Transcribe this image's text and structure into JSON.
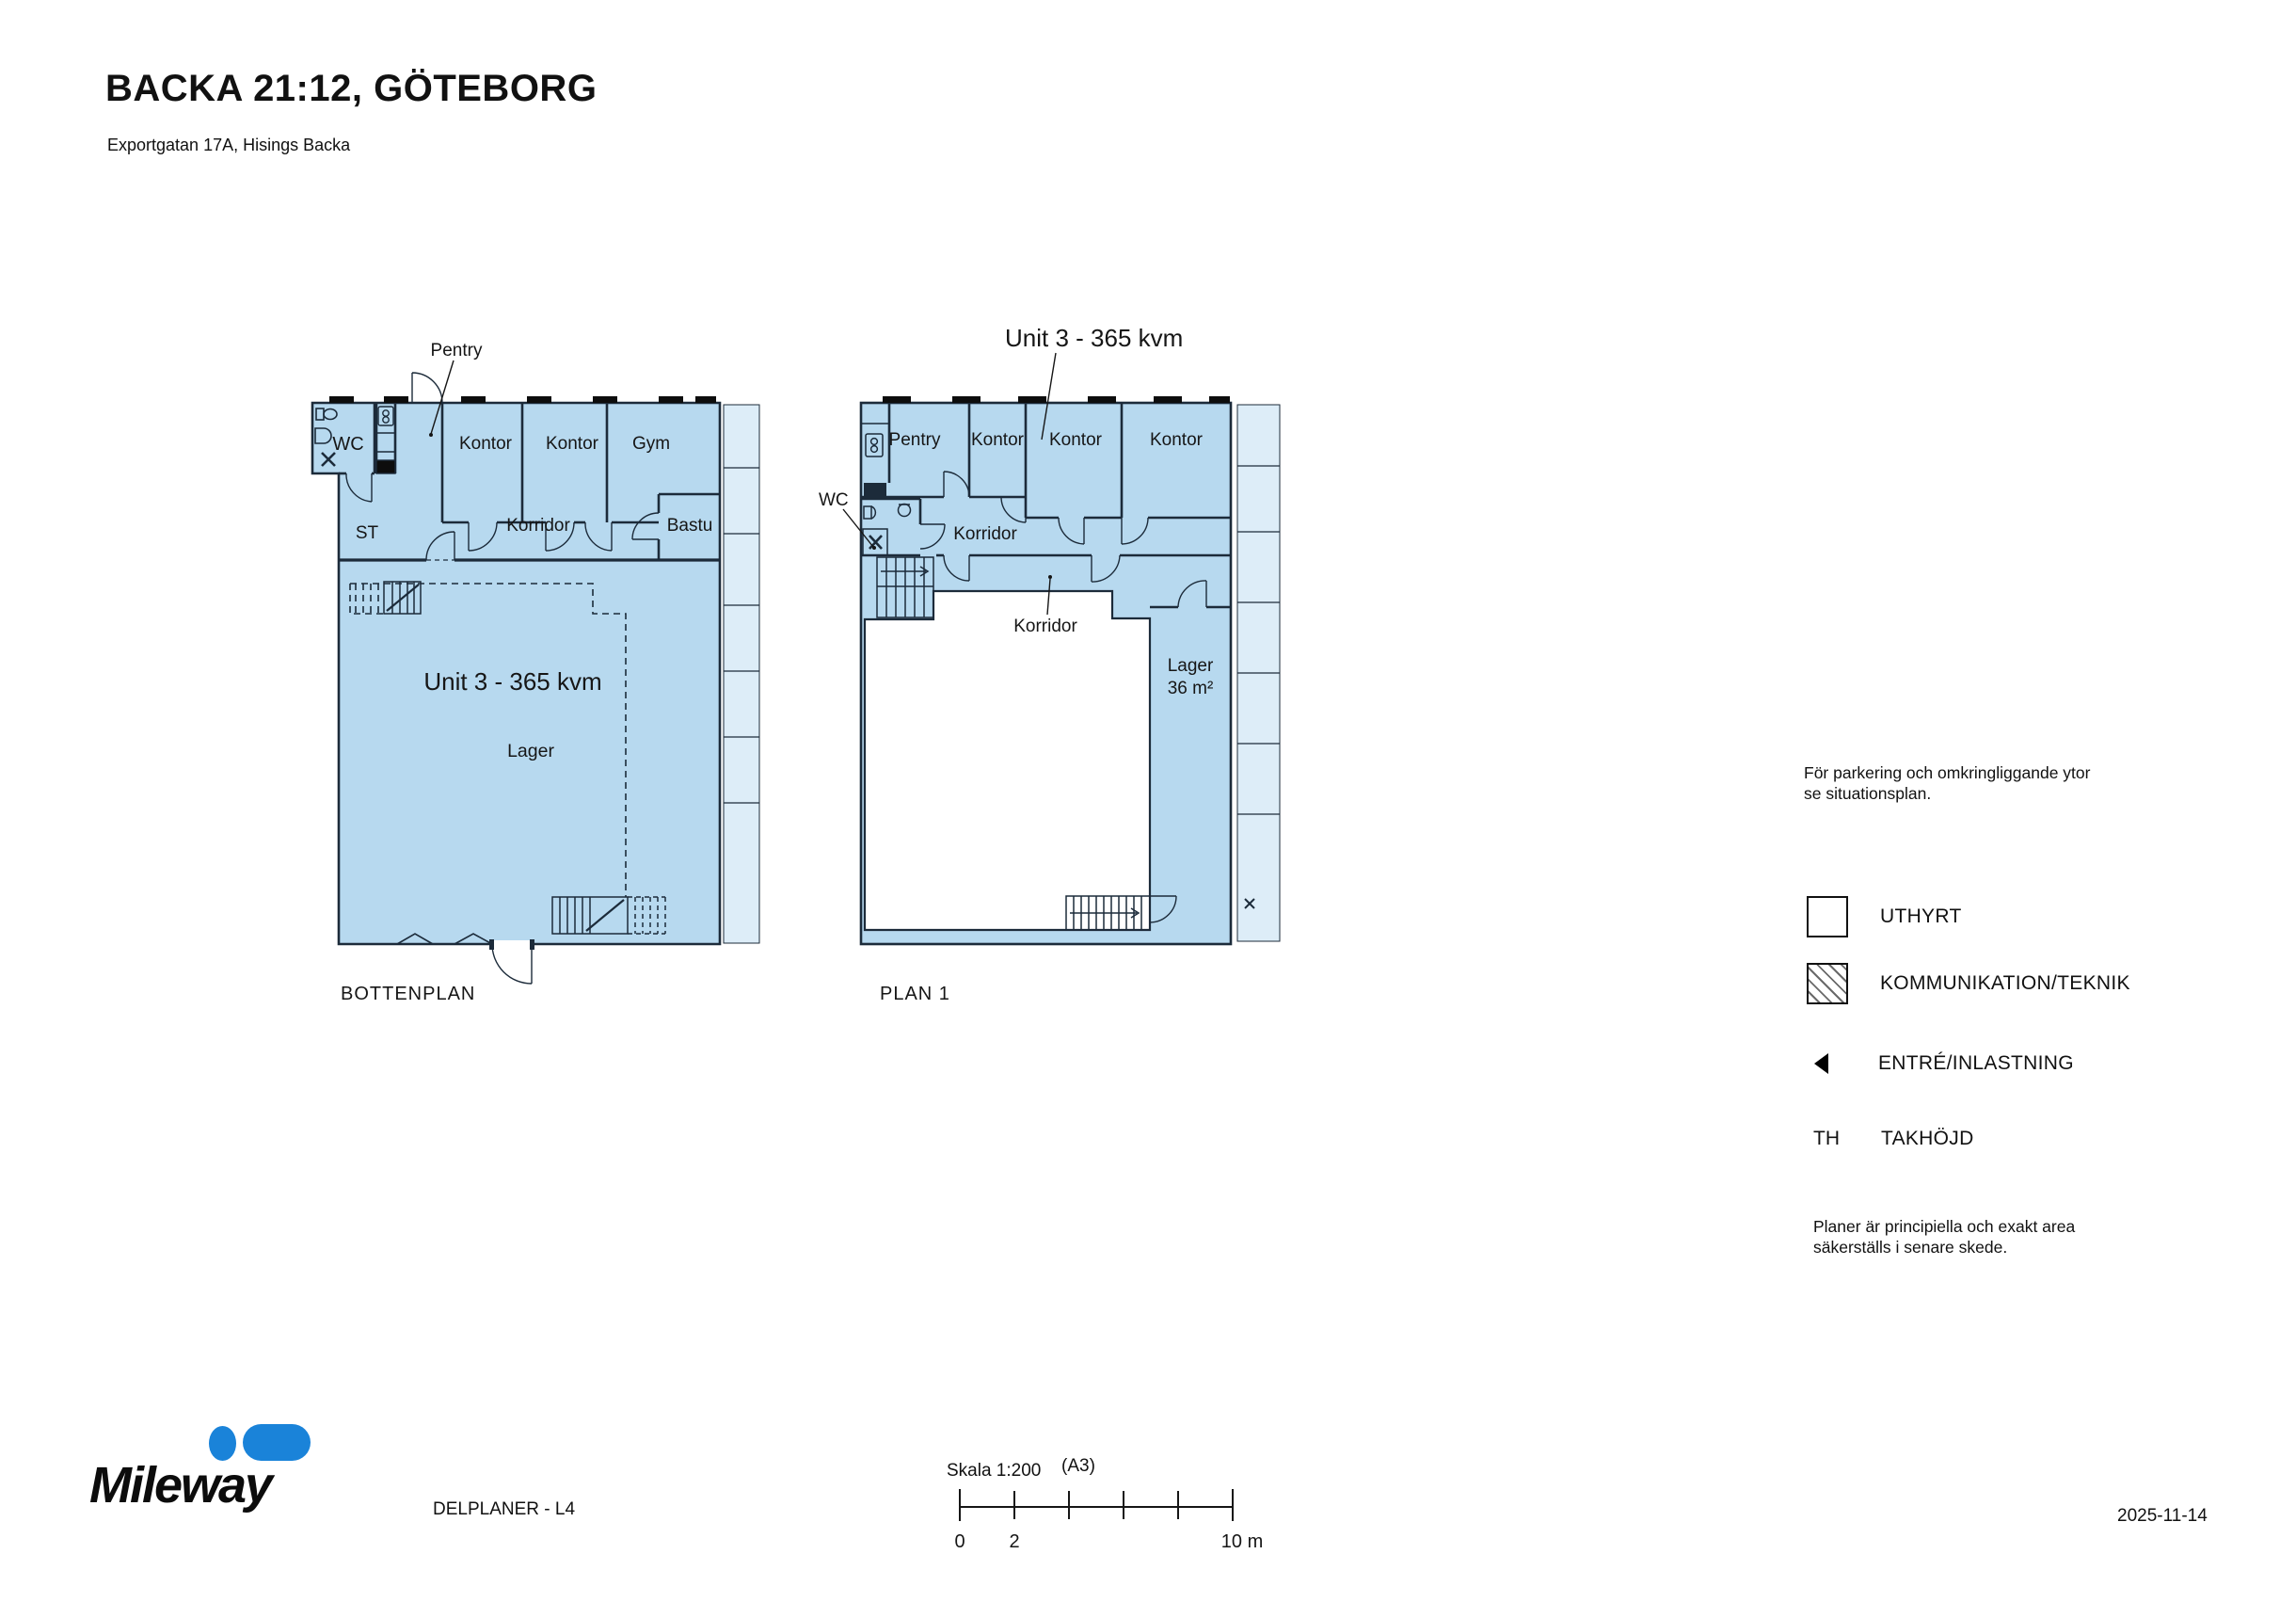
{
  "colors": {
    "unit_fill": "#b7d9ef",
    "adjacent_fill": "#ddedf8",
    "plan_line": "#1c2b3a",
    "text": "#111111",
    "mileway_blue": "#1a83d9"
  },
  "header": {
    "title": "BACKA 21:12, GÖTEBORG",
    "subtitle": "Exportgatan 17A, Hisings Backa"
  },
  "bottenplan": {
    "caption": "BOTTENPLAN",
    "unit_label": "Unit 3 - 365 kvm",
    "rooms": {
      "pentry": "Pentry",
      "wc": "WC",
      "kontor_1": "Kontor",
      "kontor_2": "Kontor",
      "gym": "Gym",
      "st": "ST",
      "korridor": "Korridor",
      "bastu": "Bastu",
      "lager": "Lager"
    }
  },
  "plan1": {
    "caption": "PLAN 1",
    "unit_label": "Unit 3 - 365 kvm",
    "rooms": {
      "pentry": "Pentry",
      "kontor_1": "Kontor",
      "kontor_2": "Kontor",
      "kontor_3": "Kontor",
      "wc": "WC",
      "korridor_upper": "Korridor",
      "korridor_lower": "Korridor",
      "lager": "Lager",
      "lager_area": "36 m²"
    }
  },
  "legend": {
    "note": "För parkering och omkringliggande ytor se situationsplan.",
    "uthyrt_label": "UTHYRT",
    "kommunikation_label": "KOMMUNIKATION/TEKNIK",
    "entre_label": "ENTRÉ/INLASTNING",
    "takhojd_abbr": "TH",
    "takhojd_label": "TAKHÖJD",
    "disclaimer": "Planer är principiella och exakt area säkerställs i senare skede."
  },
  "footer": {
    "logo_text": "Mileway",
    "doc_label": "DELPLANER - L4",
    "scale_label": "Skala 1:200",
    "sheet_format": "(A3)",
    "tick_0": "0",
    "tick_2": "2",
    "tick_10": "10 m",
    "date": "2025-11-14"
  }
}
